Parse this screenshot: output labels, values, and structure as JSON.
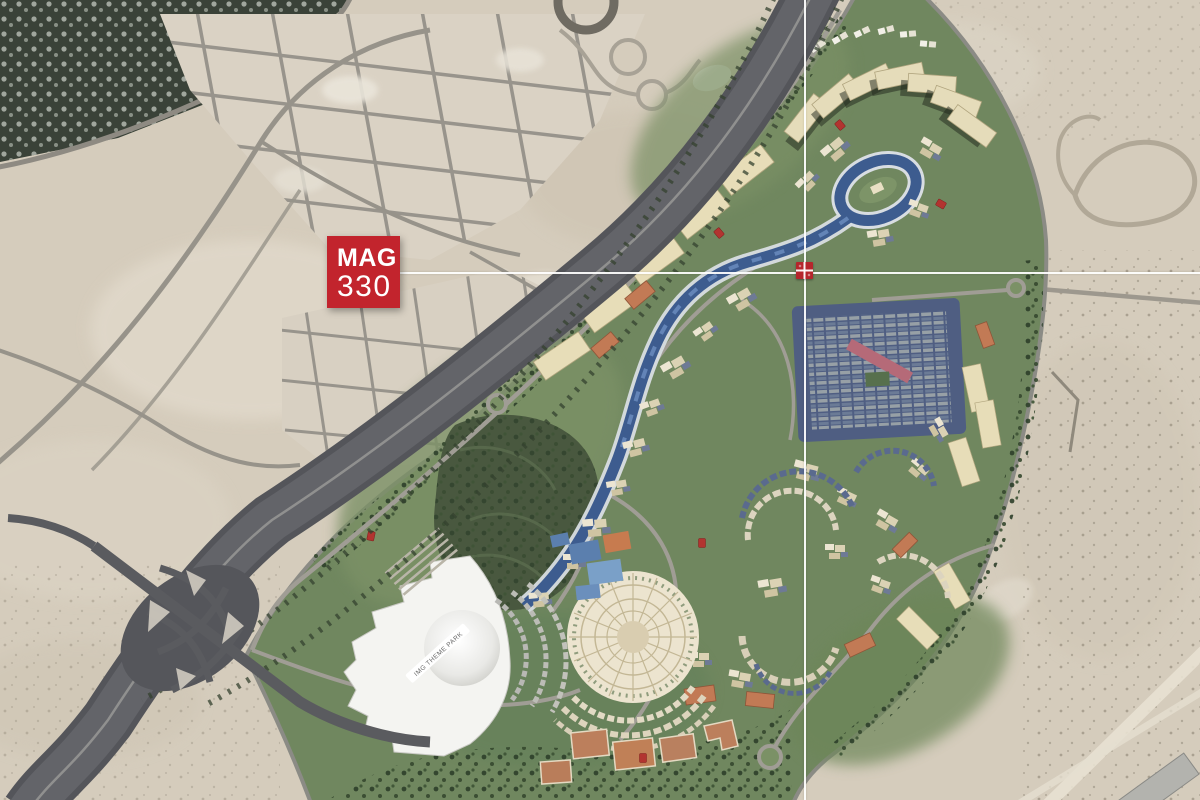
{
  "overlay": {
    "project_label": {
      "line1": "MAG",
      "line2": "330"
    },
    "marker_name": "mag-location-marker"
  },
  "map_labels": {
    "theme_park": "IMG THEME PARK"
  },
  "colors": {
    "brand_red": "#c2242d",
    "marker_red": "#b5262c",
    "crosshair_white": "#ffffff",
    "desert_sand": "#d5ccbc",
    "masterplan_green": "#70875f",
    "water_blue": "#3d5c8f",
    "highway_gray": "#55565b",
    "building_cream": "#e7ddb8",
    "sports_field_clay": "#bc7f5c"
  }
}
